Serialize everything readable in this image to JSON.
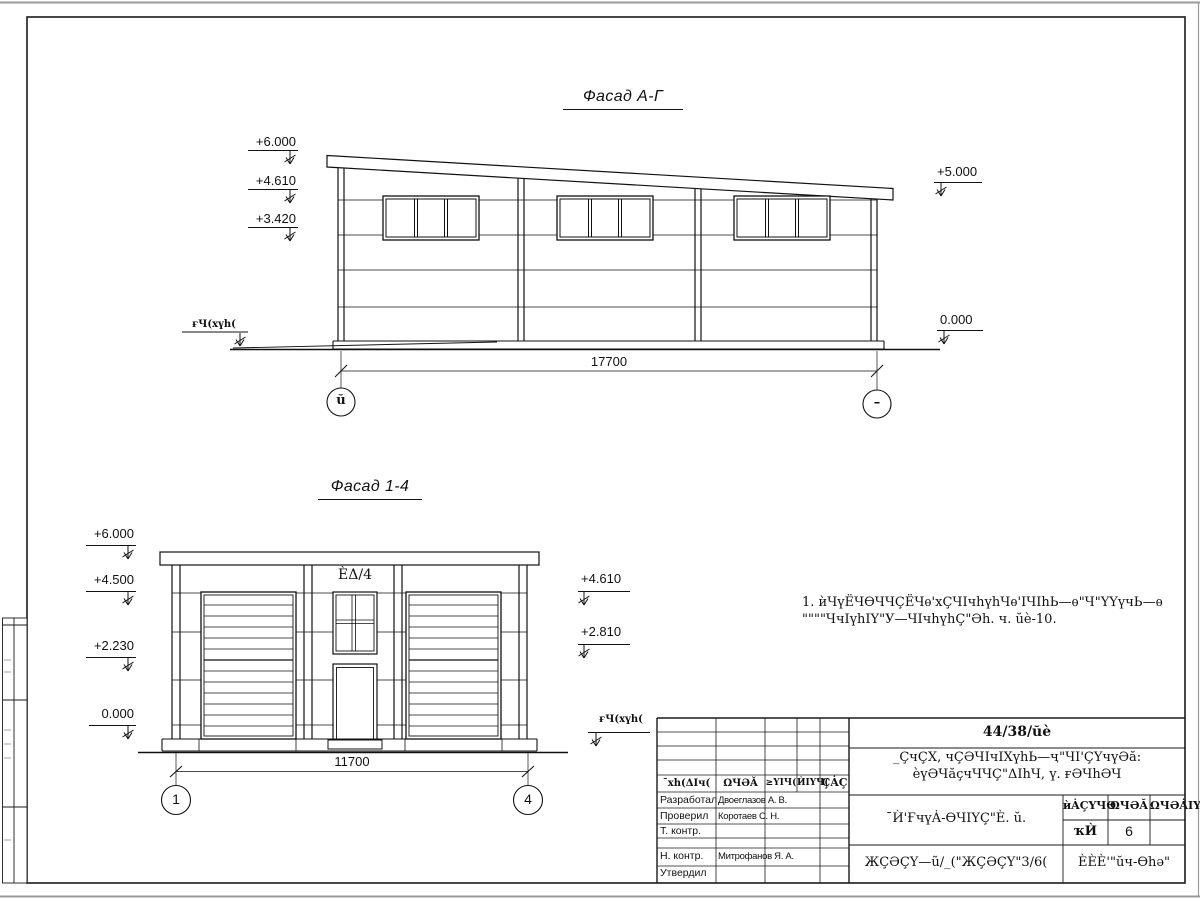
{
  "drawing": {
    "facade_ag": {
      "title": "Фасад А-Г",
      "elevations_left": [
        "+6.000",
        "+4.610",
        "+3.420"
      ],
      "elevations_right": [
        "+5.000",
        "0.000"
      ],
      "ground_label": "ғЧ(хүһ(",
      "dimension": "17700",
      "axis_left": "ŭ",
      "axis_right": "–"
    },
    "facade_14": {
      "title": "Фасад 1-4",
      "elevations_left": [
        "+6.000",
        "+4.500",
        "+2.230",
        "0.000"
      ],
      "elevations_right": [
        "+4.610",
        "+2.810"
      ],
      "ground_label": "ғЧ(хүһ(",
      "window_label": "ÈΔ/4",
      "dimension": "11700",
      "axis_left": "1",
      "axis_right": "4"
    },
    "note": {
      "line1": "1. ѝЧүЁЧѲЧЧÇЁЧѳ'хÇЧΙчһүһЧѳ'ΙЧΙһЬ—ѳ\"Ч\"ҮҮүчЬ—ѳ",
      "line2": "\"\"\"\"ЧчΙүһΙҮ\"У—ЧΙчһүһÇ\"Әһ. ч. ŭè-10."
    }
  },
  "title_block": {
    "doc_number": "44/38/ŭè",
    "project_line1": "_ÇчÇХ, чÇӘЧΙчΙХүһЬ—ҷ\"ЧΙ'ÇҮчүӘă:",
    "project_line2": "èүӘЧăçчЧЧÇ\"ΔΙһЧ, ү. ғӘЧһӘЧ",
    "sheet_title": "¯Ѝ'ҒчүȦ-ѲЧΙҮÇ\"È. ŭ.",
    "header_cells": [
      "¯хһ(ΔΙч(",
      "ΩЧӘĂ",
      "≥ҮΙЧ(",
      "ЍΙҮЧ(",
      "ÇȦÇ"
    ],
    "rows": [
      {
        "label": "Разработал",
        "name": "Двоеглазов А. В."
      },
      {
        "label": "Проверил",
        "name": "Коротаев С. Н."
      },
      {
        "label": "Т. контр.",
        "name": ""
      },
      {
        "label": "Н. контр.",
        "name": "Митрофанов Я. А."
      },
      {
        "label": "Утвердил",
        "name": ""
      }
    ],
    "stage_headers": [
      "ѝȦÇҮЧѲ",
      "ΩЧӘĂ",
      "ΩЧӘȦΙҮ"
    ],
    "stage_value": "ҡЍ",
    "sheet_number": "6",
    "doc_code": "ЖÇӘÇҮ—ũ/_(\"ЖÇӘÇҮ\"3/6(",
    "company": "ÈÈÈ'\"ŭч-Ѳһә\""
  }
}
